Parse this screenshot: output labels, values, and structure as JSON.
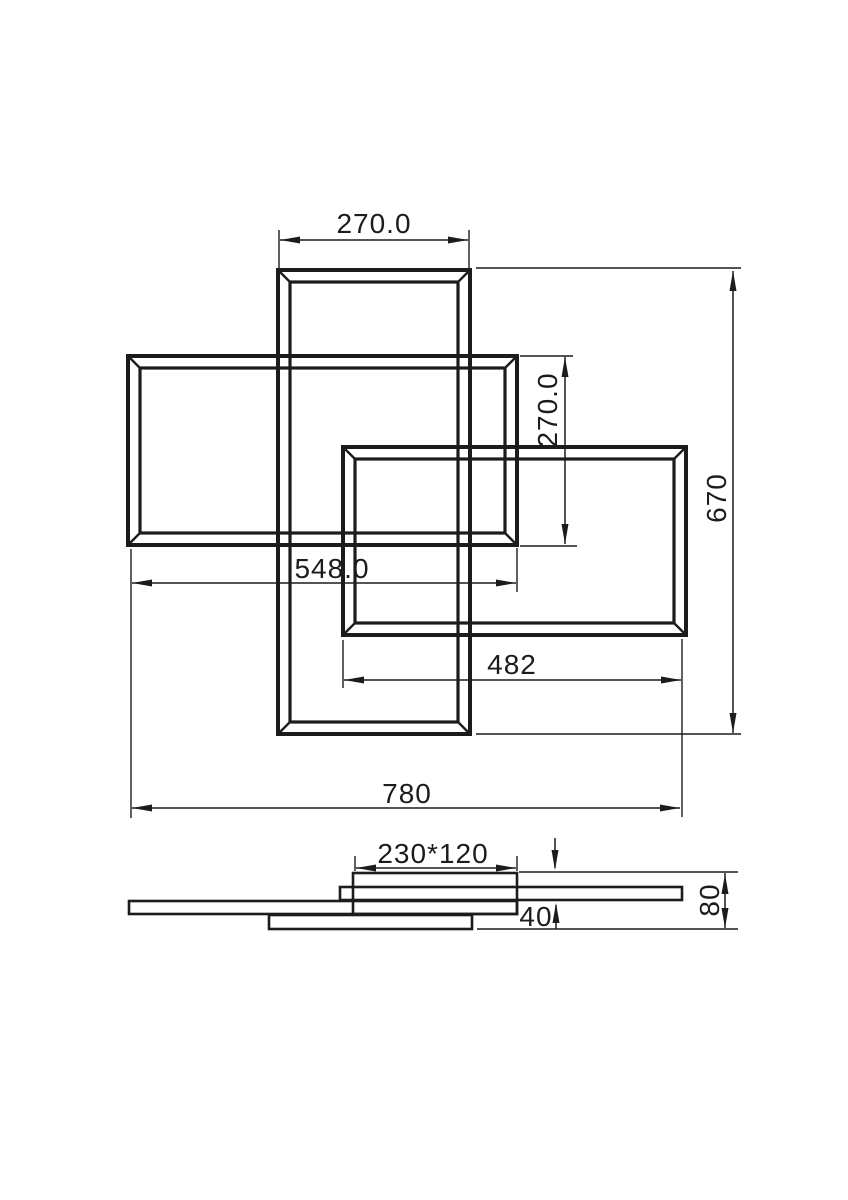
{
  "drawing": {
    "type": "technical-dimension-drawing",
    "subject": "overlapping rectangular frame ceiling lamp, plan view and side elevation",
    "background_color": "#ffffff",
    "line_color": "#1c1c1c",
    "dims": {
      "center_frame_width": "270.0",
      "left_frame_height": "270.0",
      "left_frame_width": "548.0",
      "right_frame_width": "482",
      "overall_width": "780",
      "overall_height": "670",
      "canopy_size": "230*120",
      "body_height": "40",
      "total_height": "80"
    }
  }
}
